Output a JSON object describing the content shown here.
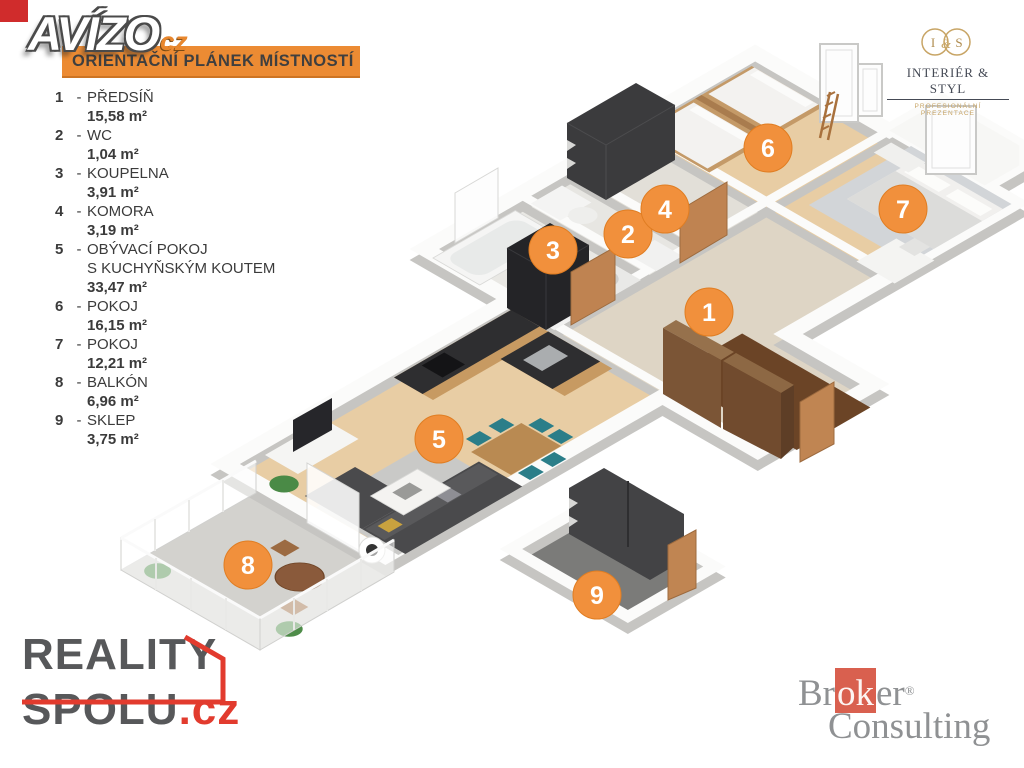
{
  "watermark": {
    "text": "AVÍZO",
    "suffix": "cz"
  },
  "banner": {
    "title": "ORIENTAČNÍ PLÁNEK MÍSTNOSTÍ"
  },
  "legend": {
    "dash": "-",
    "items": [
      {
        "num": "1",
        "name": "PŘEDSÍŇ",
        "area": "15,58 m²"
      },
      {
        "num": "2",
        "name": "WC",
        "area": "1,04 m²"
      },
      {
        "num": "3",
        "name": "KOUPELNA",
        "area": "3,91 m²"
      },
      {
        "num": "4",
        "name": "KOMORA",
        "area": "3,19 m²"
      },
      {
        "num": "5",
        "name": "OBÝVACÍ POKOJ",
        "name2": "S KUCHYŇSKÝM KOUTEM",
        "area": "33,47 m²"
      },
      {
        "num": "6",
        "name": "POKOJ",
        "area": "16,15 m²"
      },
      {
        "num": "7",
        "name": "POKOJ",
        "area": "12,21 m²"
      },
      {
        "num": "8",
        "name": "BALKÓN",
        "area": "6,96 m²"
      },
      {
        "num": "9",
        "name": "SKLEP",
        "area": "3,75 m²"
      }
    ]
  },
  "plan": {
    "markers": [
      "1",
      "2",
      "3",
      "4",
      "5",
      "6",
      "7",
      "8",
      "9"
    ]
  },
  "logos": {
    "interier_styl": {
      "monogram_i": "I",
      "monogram_amp": "&",
      "monogram_s": "S",
      "line1": "INTERIÉR & STYL",
      "line2": "PROFESIONÁLNÍ PREZENTACE"
    },
    "reality_spolu": {
      "line1": "REALITY",
      "line2": "SPOLU",
      "tld": ".cz"
    },
    "broker": {
      "pre": "Br",
      "mid": "ok",
      "post": "er",
      "reg": "®",
      "line2": "Consulting"
    }
  },
  "colors": {
    "banner_orange": "#ec8b33",
    "marker_orange": "#f1903c",
    "corner_red": "#d02c2c",
    "reality_red": "#e23b2e",
    "reality_gray": "#57585a",
    "broker_red": "#d9604f",
    "broker_gray": "#8f9193",
    "interier_gold": "#c8a566",
    "floor_wood": "#e8cda4",
    "floor_tile": "#ded5c5",
    "wall_white": "#fbfbfa",
    "dark_furniture": "#3b3b3d"
  }
}
